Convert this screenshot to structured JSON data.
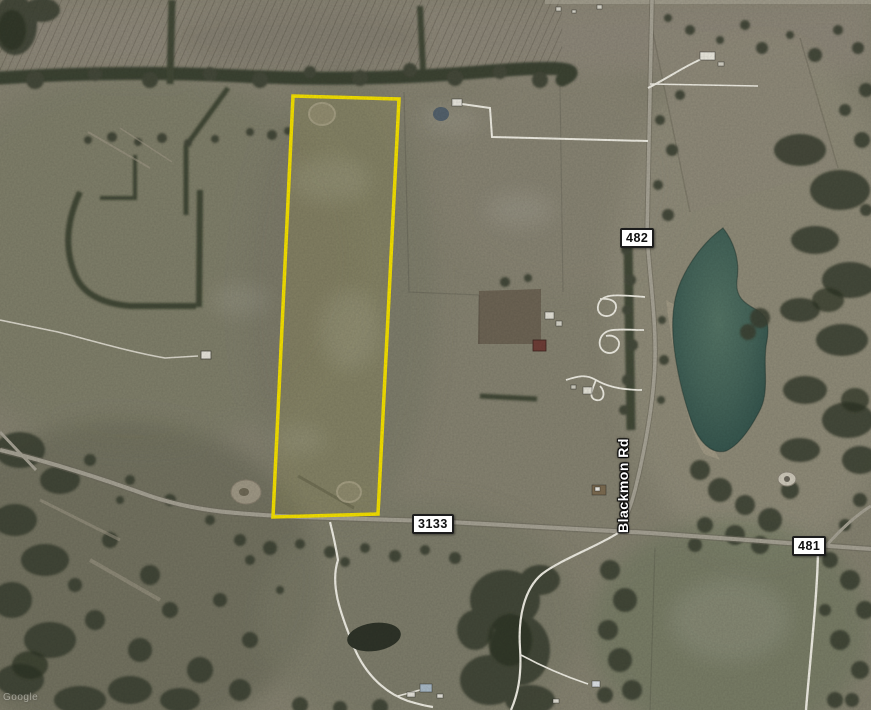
{
  "image": {
    "type": "satellite-aerial-view",
    "watermark": "Google"
  },
  "road_labels": [
    {
      "text": "482"
    },
    {
      "text": "3133"
    },
    {
      "text": "481"
    }
  ],
  "street_name": "Blackmon Rd",
  "parcel": {
    "outline_points": "293,96 399,99 378,514 273,517"
  },
  "colors": {
    "parcel-outline": "#f6e200",
    "lake": "#4a6b60",
    "lake-deep": "#30504a",
    "terrain": "#85826f",
    "terrain-dark": "#6e705c",
    "terrain-tan": "#958f7c",
    "trees": "#3a4130",
    "trees-dark": "#2b3222",
    "road": "#a6a294",
    "driveway": "#f0eee4",
    "label-bg": "#ffffff",
    "label-text": "#111111",
    "street-text": "#ffffff"
  }
}
